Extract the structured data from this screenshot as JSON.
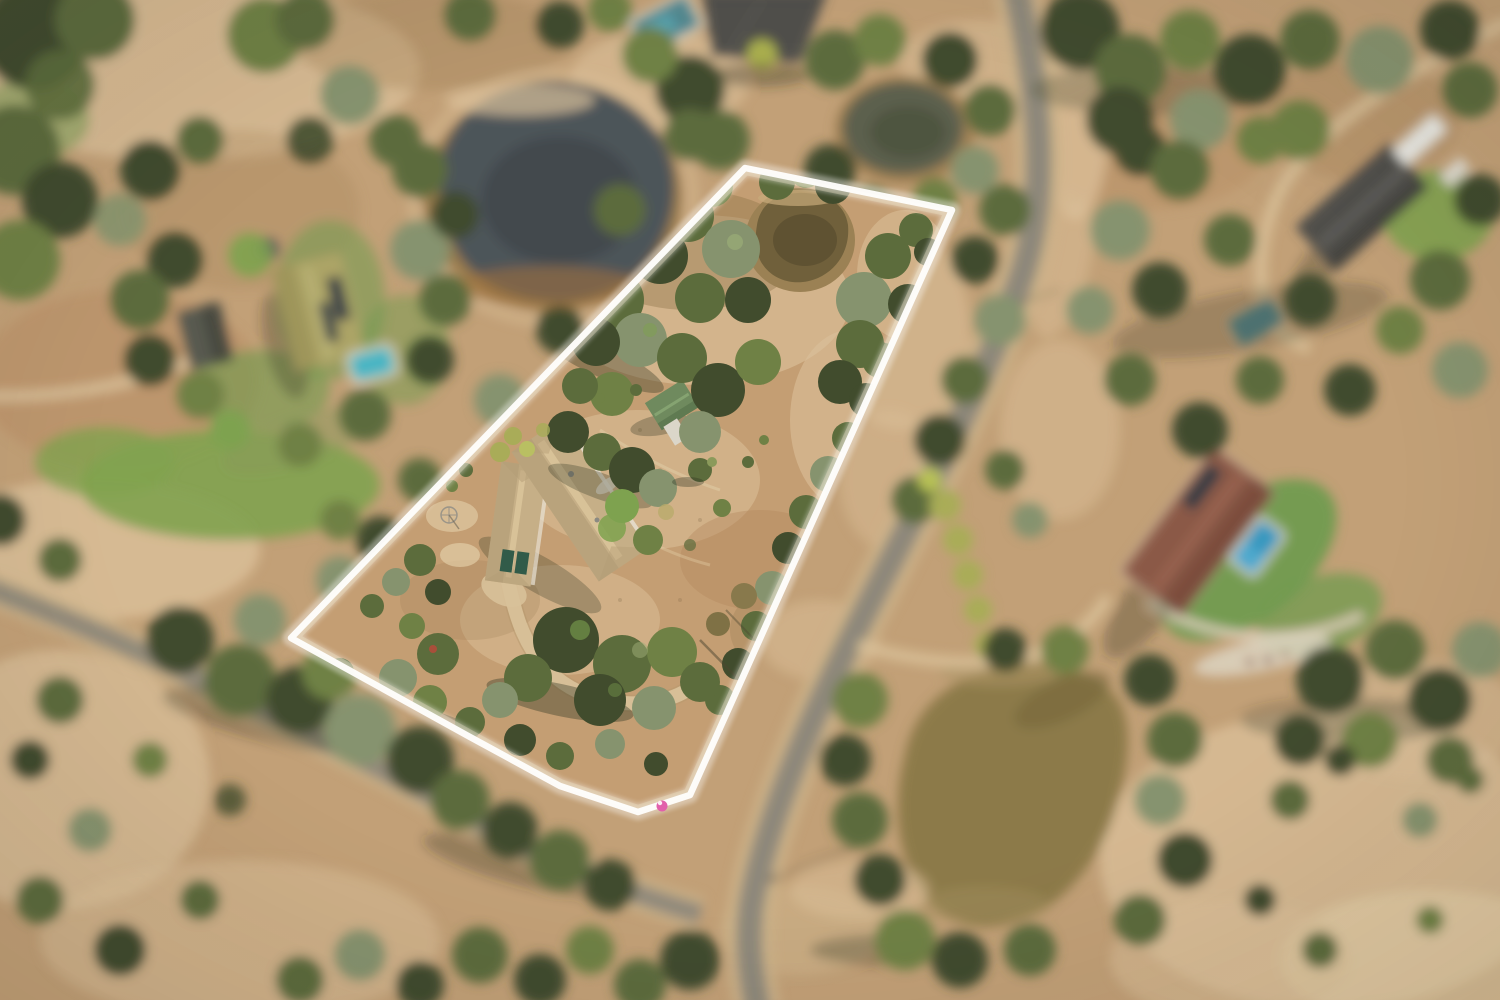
{
  "meta": {
    "type": "aerial-drone-photograph",
    "subject": "rural residential acreage property highlighted with a white lot-boundary outline",
    "effect": "tilt-shift style: featured lot in sharp focus, all surroundings blurred",
    "width": 1500,
    "height": 1000
  },
  "palette": {
    "dirtBase": "#c2a078",
    "dirtIn": "#c49e74",
    "dirtLight": "#dcc29c",
    "dirtPale": "#e9d7b2",
    "dirtDark": "#a5855c",
    "dirtRed": "#b58a62",
    "grass": "#7fa24f",
    "lawn": "#6f9b50",
    "treeDark": "#3e4a2d",
    "treeOlive": "#5a6b3c",
    "treeMid": "#6d8045",
    "treeGray": "#85936f",
    "treeBright": "#7ca24f",
    "treeYellow": "#a8ad59",
    "shadow": "#2b3220",
    "roadAsphalt": "#8d887b",
    "roadEdge": "#cdb48c",
    "gravel": "#d9c29b",
    "damWater": "#49525a",
    "damWaterDark": "#3d454c",
    "damShore": "#97794c",
    "mudRing": "#9c6f3e",
    "pondOlive": "#5a5e4e",
    "pondMud": "#8b7948",
    "lotDamWater": "#6e5f3b",
    "lotDamDark": "#5a4d31",
    "roofTan": "#c6b089",
    "roofTanShade": "#ab9571",
    "ridgeLight": "#dcc79e",
    "wallWhite": "#e9e4d8",
    "garageGreen": "#2e5a49",
    "shedGreen": "#6d8a5f",
    "roofLeftOlive": "#aca468",
    "solarDark": "#2c3946",
    "poolTeal": "#46b6c6",
    "roofRight": "#8a5847",
    "roofRightShade": "#6e4336",
    "ridgeRight": "#a06a55",
    "poolBlue": "#3598c2",
    "paving": "#ddd5c4",
    "whitePath": "#ddd2bd",
    "roofGray": "#4d4d4b",
    "roofTeal": "#4f8792",
    "caravanWhite": "#e7e7e3",
    "boundary": "#ffffff",
    "flagPink": "#e35fae"
  },
  "boundary": {
    "points": "745,168 952,210 690,795 638,812 560,786 470,737 291,638",
    "stroke_width": 6.5,
    "glow_width": 16,
    "color": "#ffffff",
    "corner_marker": {
      "x": 662,
      "y": 806,
      "color": "#e35fae"
    }
  },
  "scene": {
    "featured_lot": [
      "small-farm-dam",
      "eucalyptus-tree-stands",
      "dry-paddock",
      "main-house-tan-hip-roof",
      "garage-wing-green-doors",
      "green-roof-shed",
      "gravel-driveway-loop",
      "garden-trees"
    ],
    "surroundings": [
      "large-dam-top-left",
      "neighbor-house-left-solar-panels",
      "teal-pool-left",
      "sealed-road-curving-north-south",
      "side-road-bottom-left",
      "road-junction-bottom",
      "neighbor-house-right-red-roof",
      "blue-pool-right",
      "muddy-pond-bottom-right",
      "small-pond-top-middle",
      "gray-roof-house-top-right",
      "dark-roof-house-top",
      "dirt-driveways",
      "dense-tree-cover",
      "dry-grass-clearings"
    ]
  }
}
